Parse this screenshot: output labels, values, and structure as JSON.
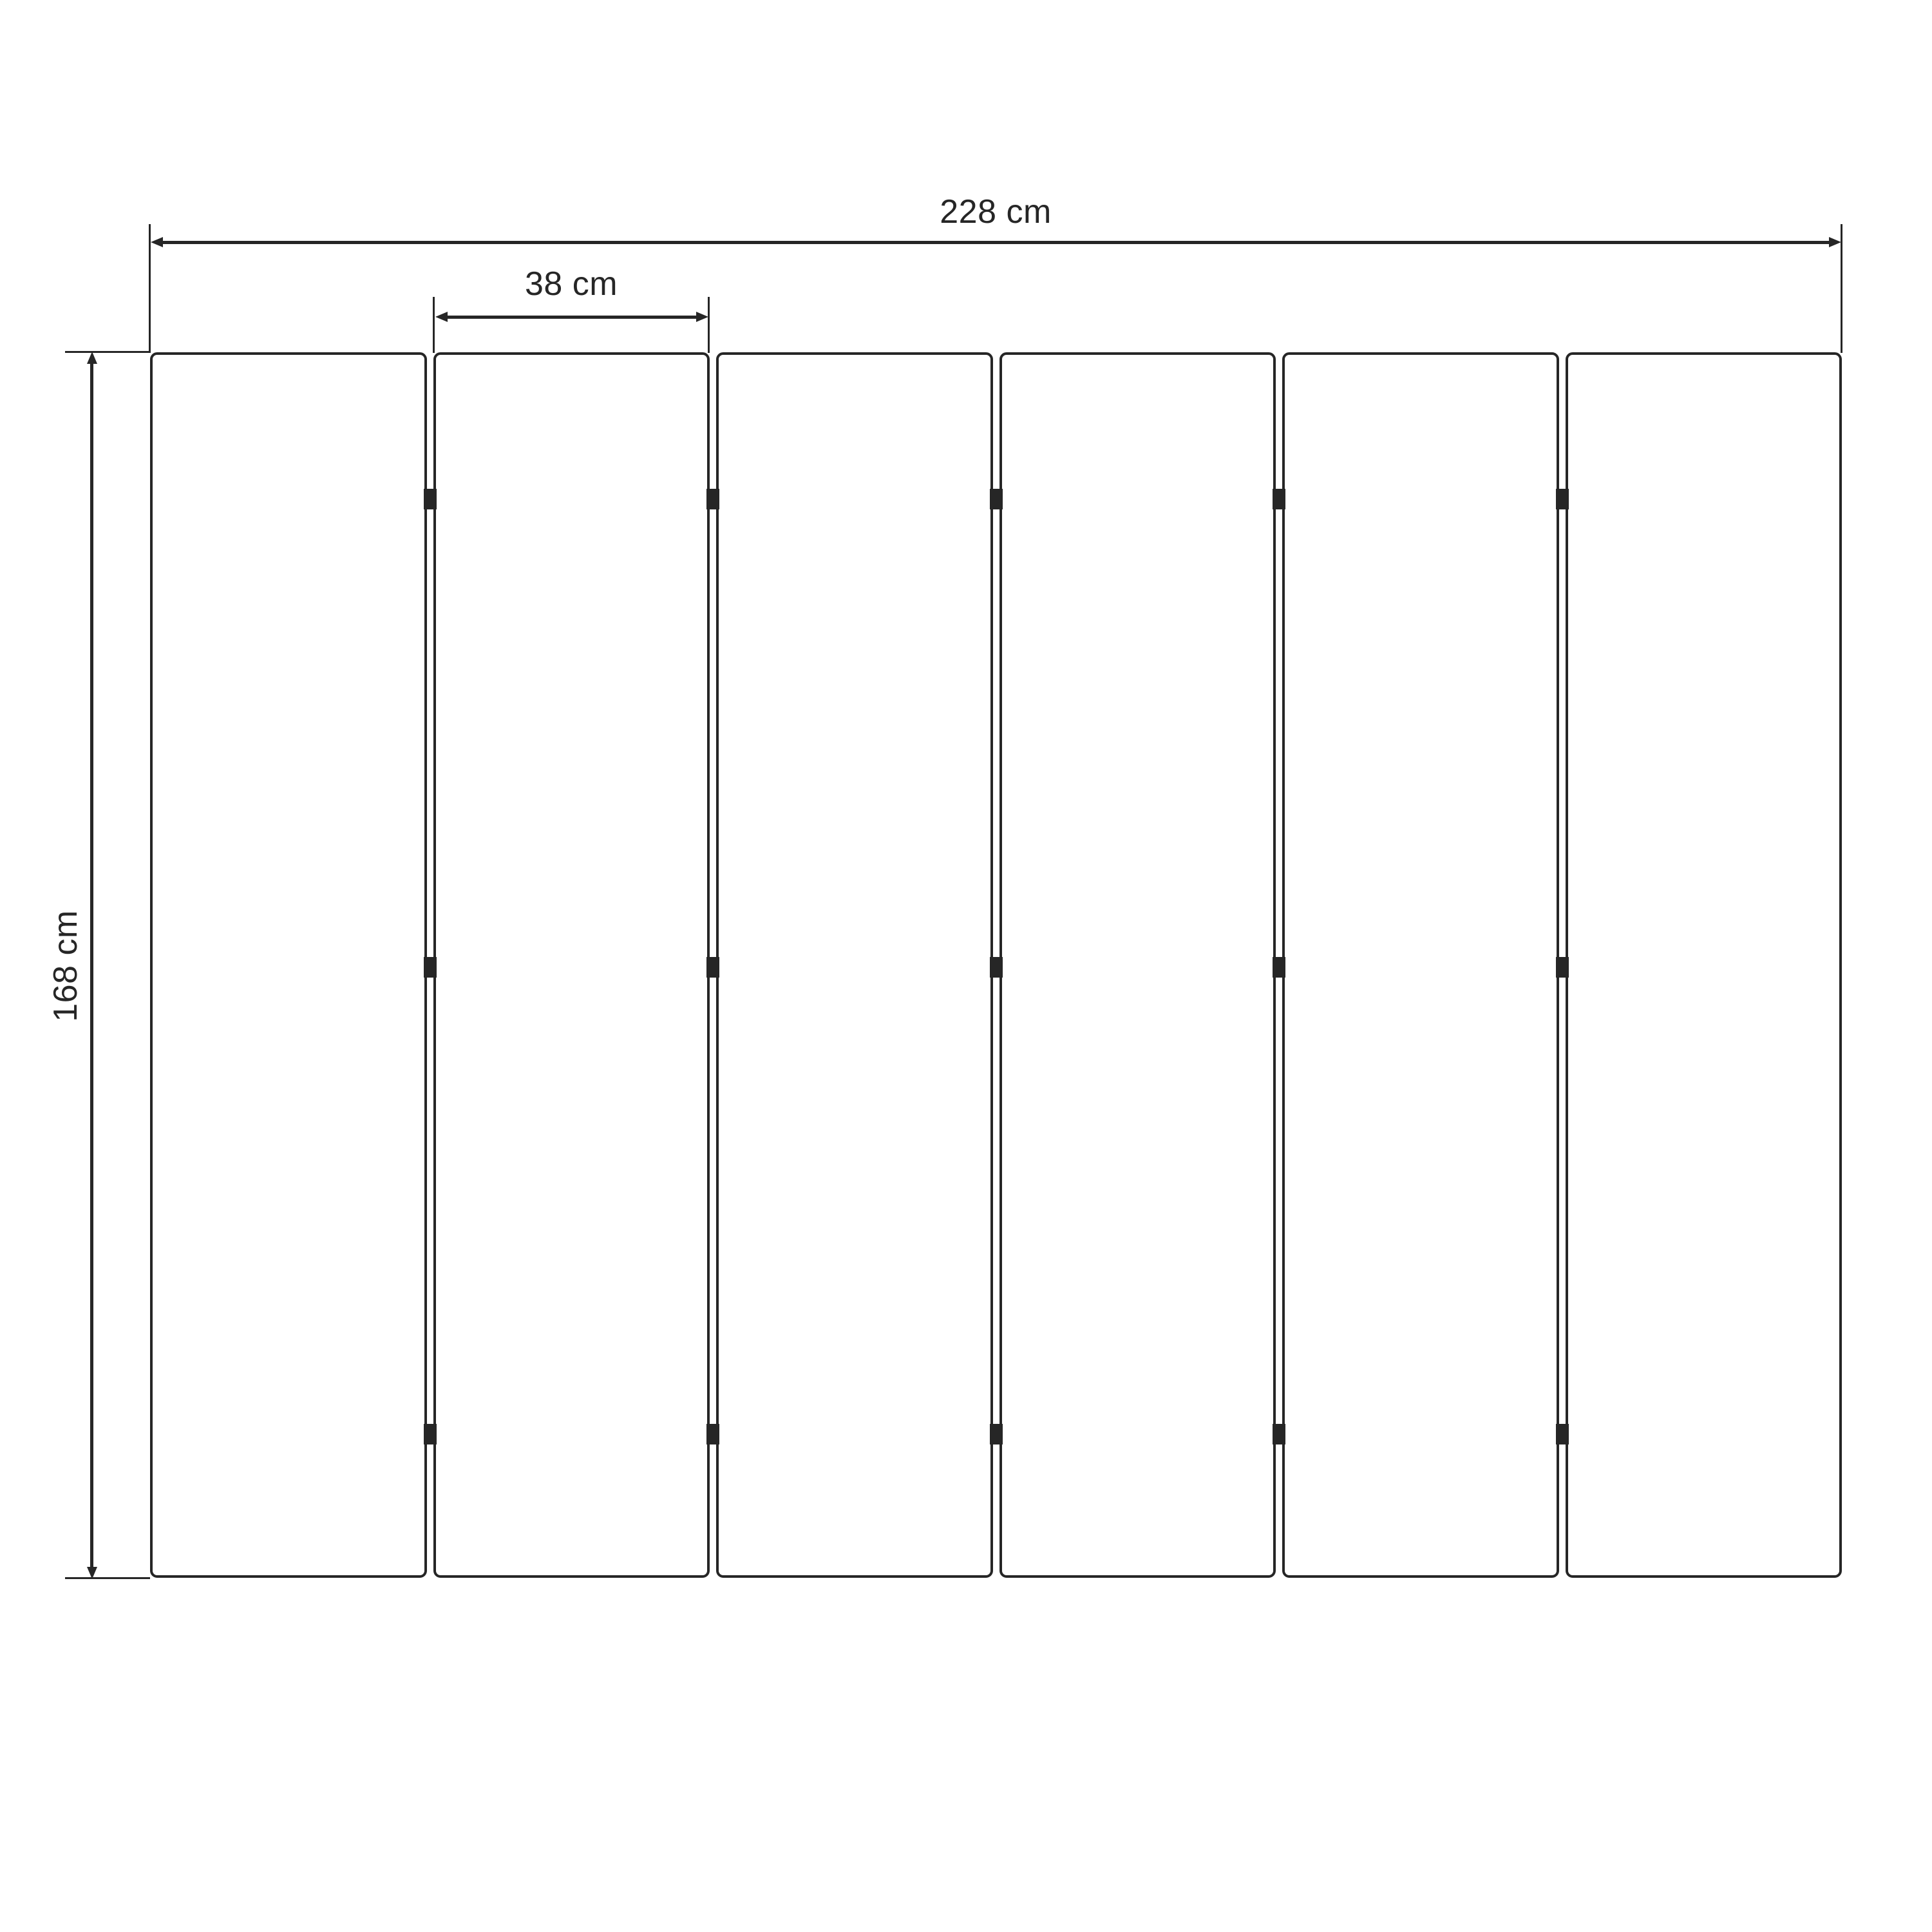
{
  "diagram": {
    "kind": "folding-screen-dimension-drawing",
    "background_color": "#ffffff",
    "line_color": "#262626",
    "labels": {
      "total_width": "228 cm",
      "panel_width": "38 cm",
      "height": "168 cm"
    },
    "panels": {
      "count": 6,
      "hinges_per_gap": 3,
      "hinge_positions_pct": [
        12,
        50.2,
        88.3
      ]
    }
  }
}
